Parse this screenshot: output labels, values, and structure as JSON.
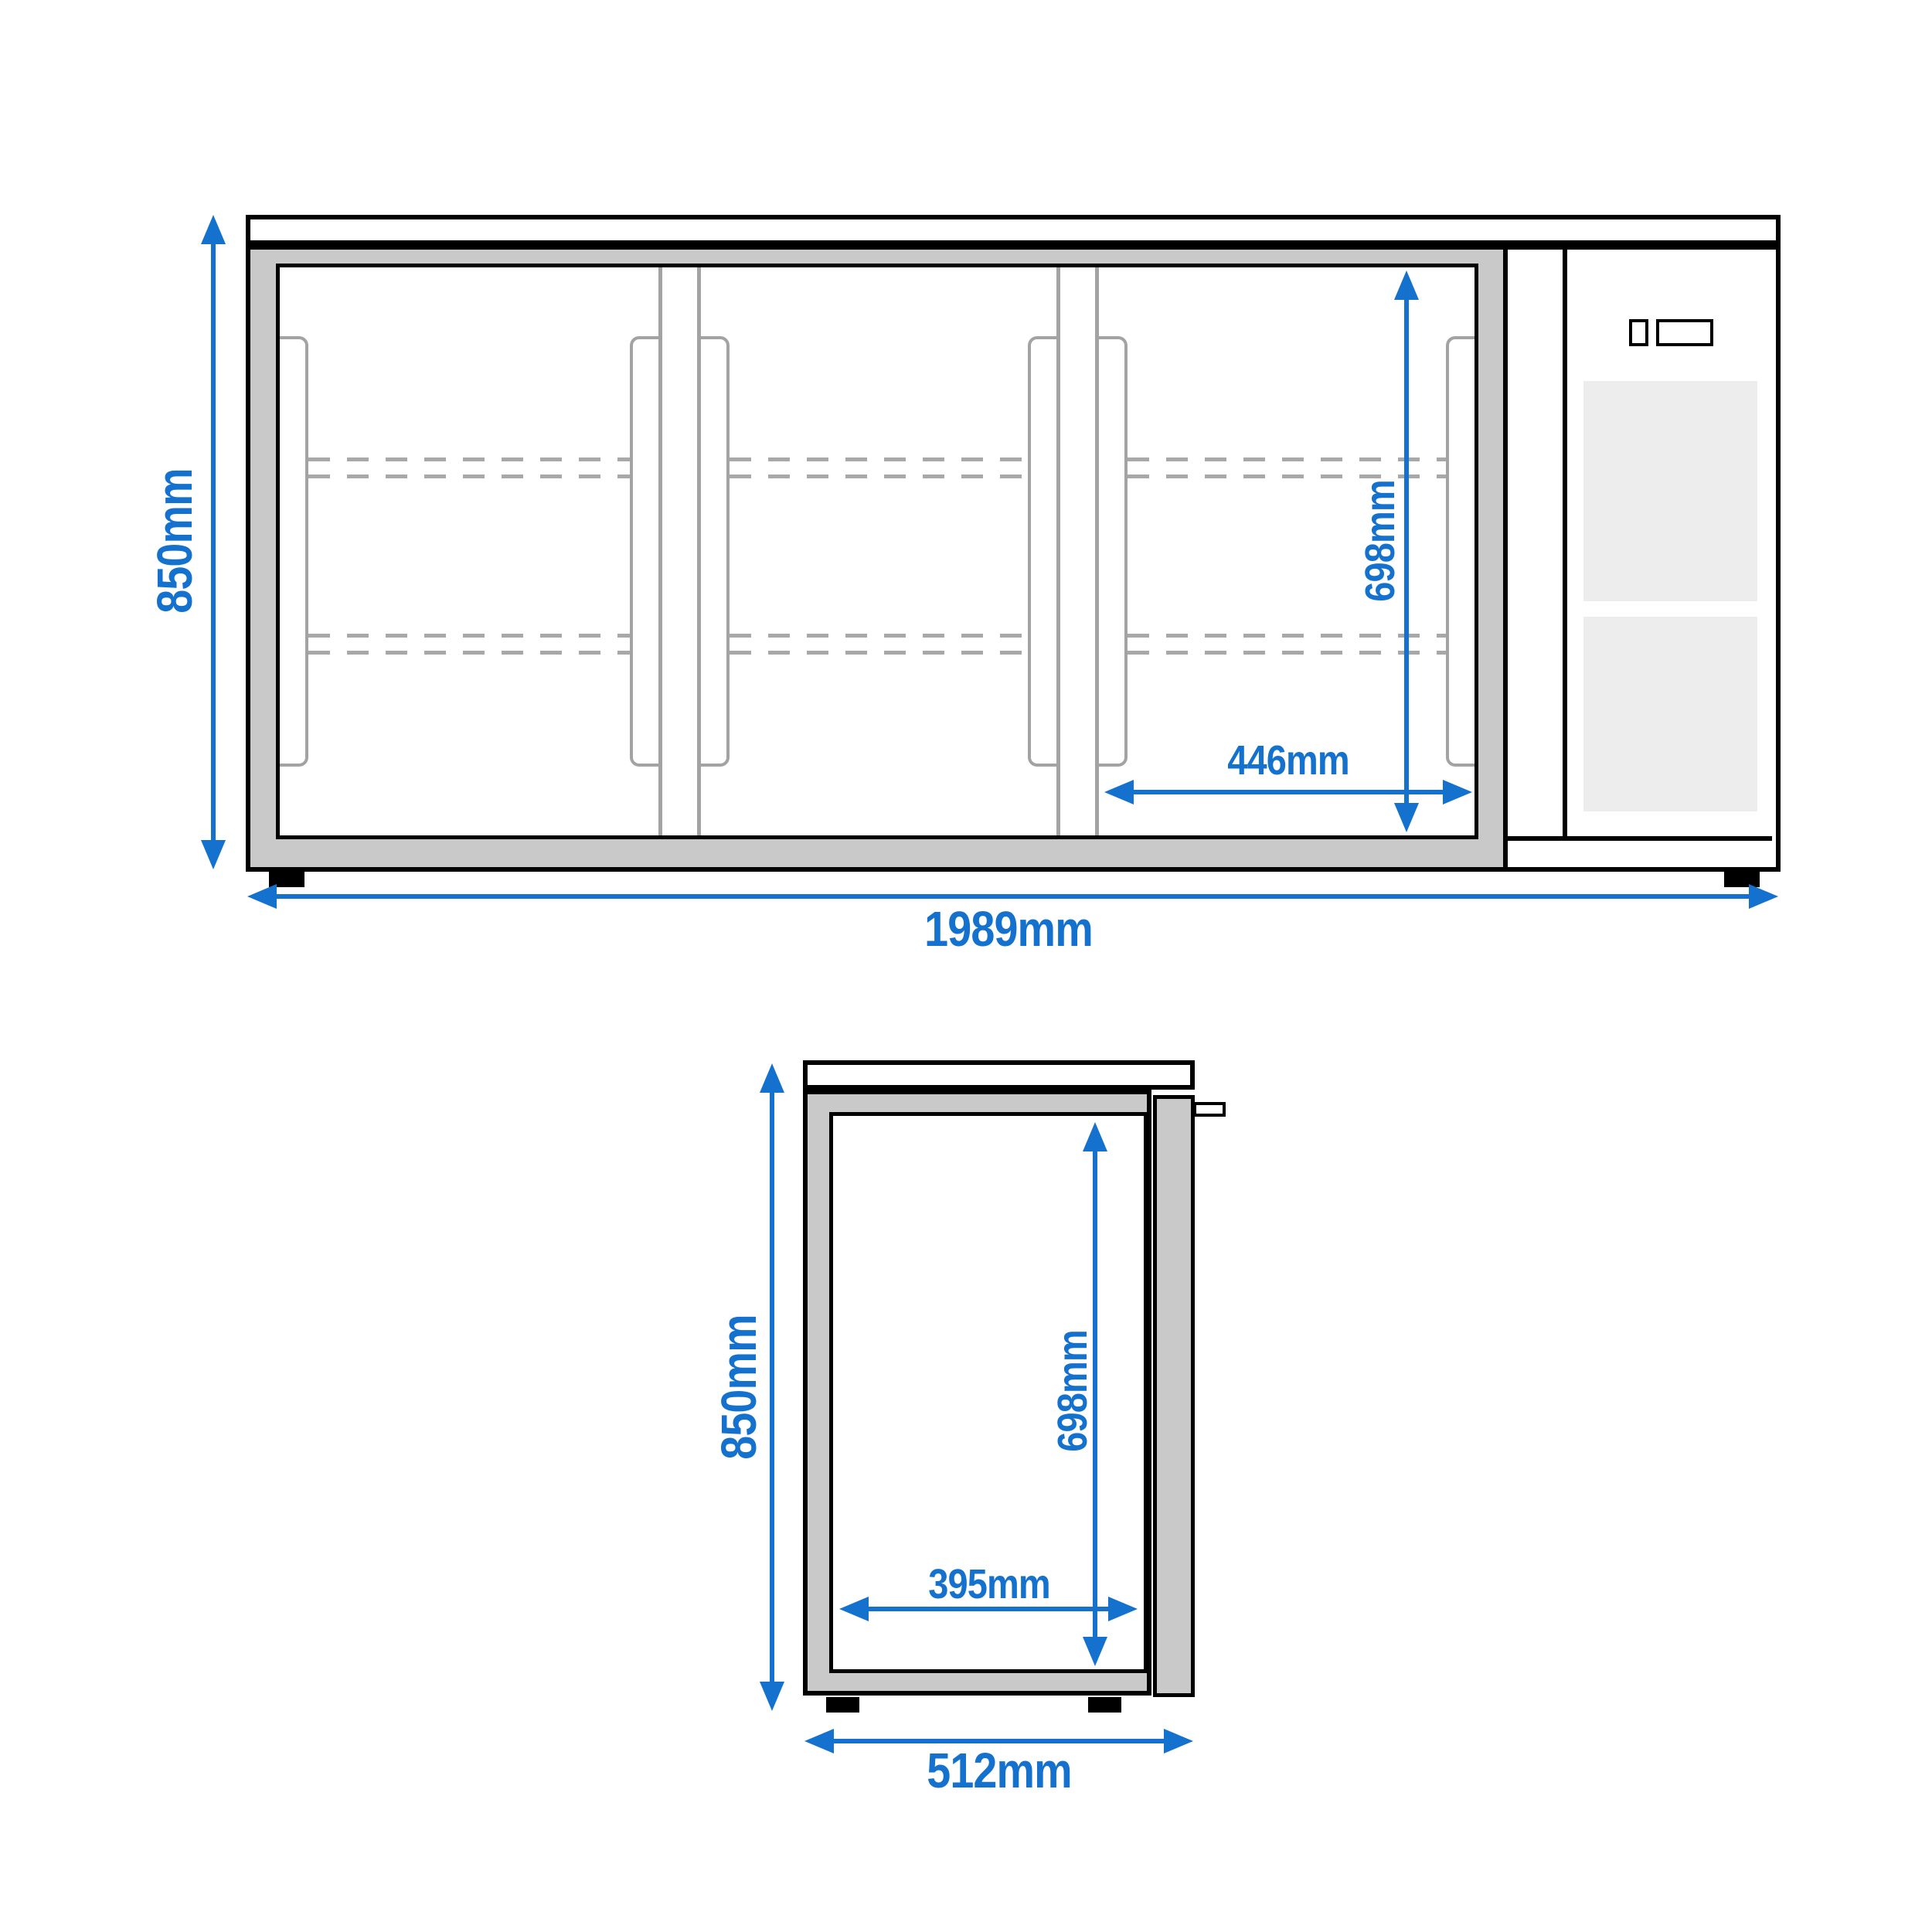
{
  "colors": {
    "dimension_blue": "#1471cd",
    "frame_gray": "#c9c9c9",
    "vent_panel_gray": "#ededed",
    "door_outline_gray": "#a3a3a3"
  },
  "front_view": {
    "height_label": "850mm",
    "width_label": "1989mm",
    "door_height_label": "698mm",
    "door_width_label": "446mm"
  },
  "side_view": {
    "height_label": "850mm",
    "interior_height_label": "698mm",
    "interior_width_label": "395mm",
    "depth_label": "512mm"
  }
}
